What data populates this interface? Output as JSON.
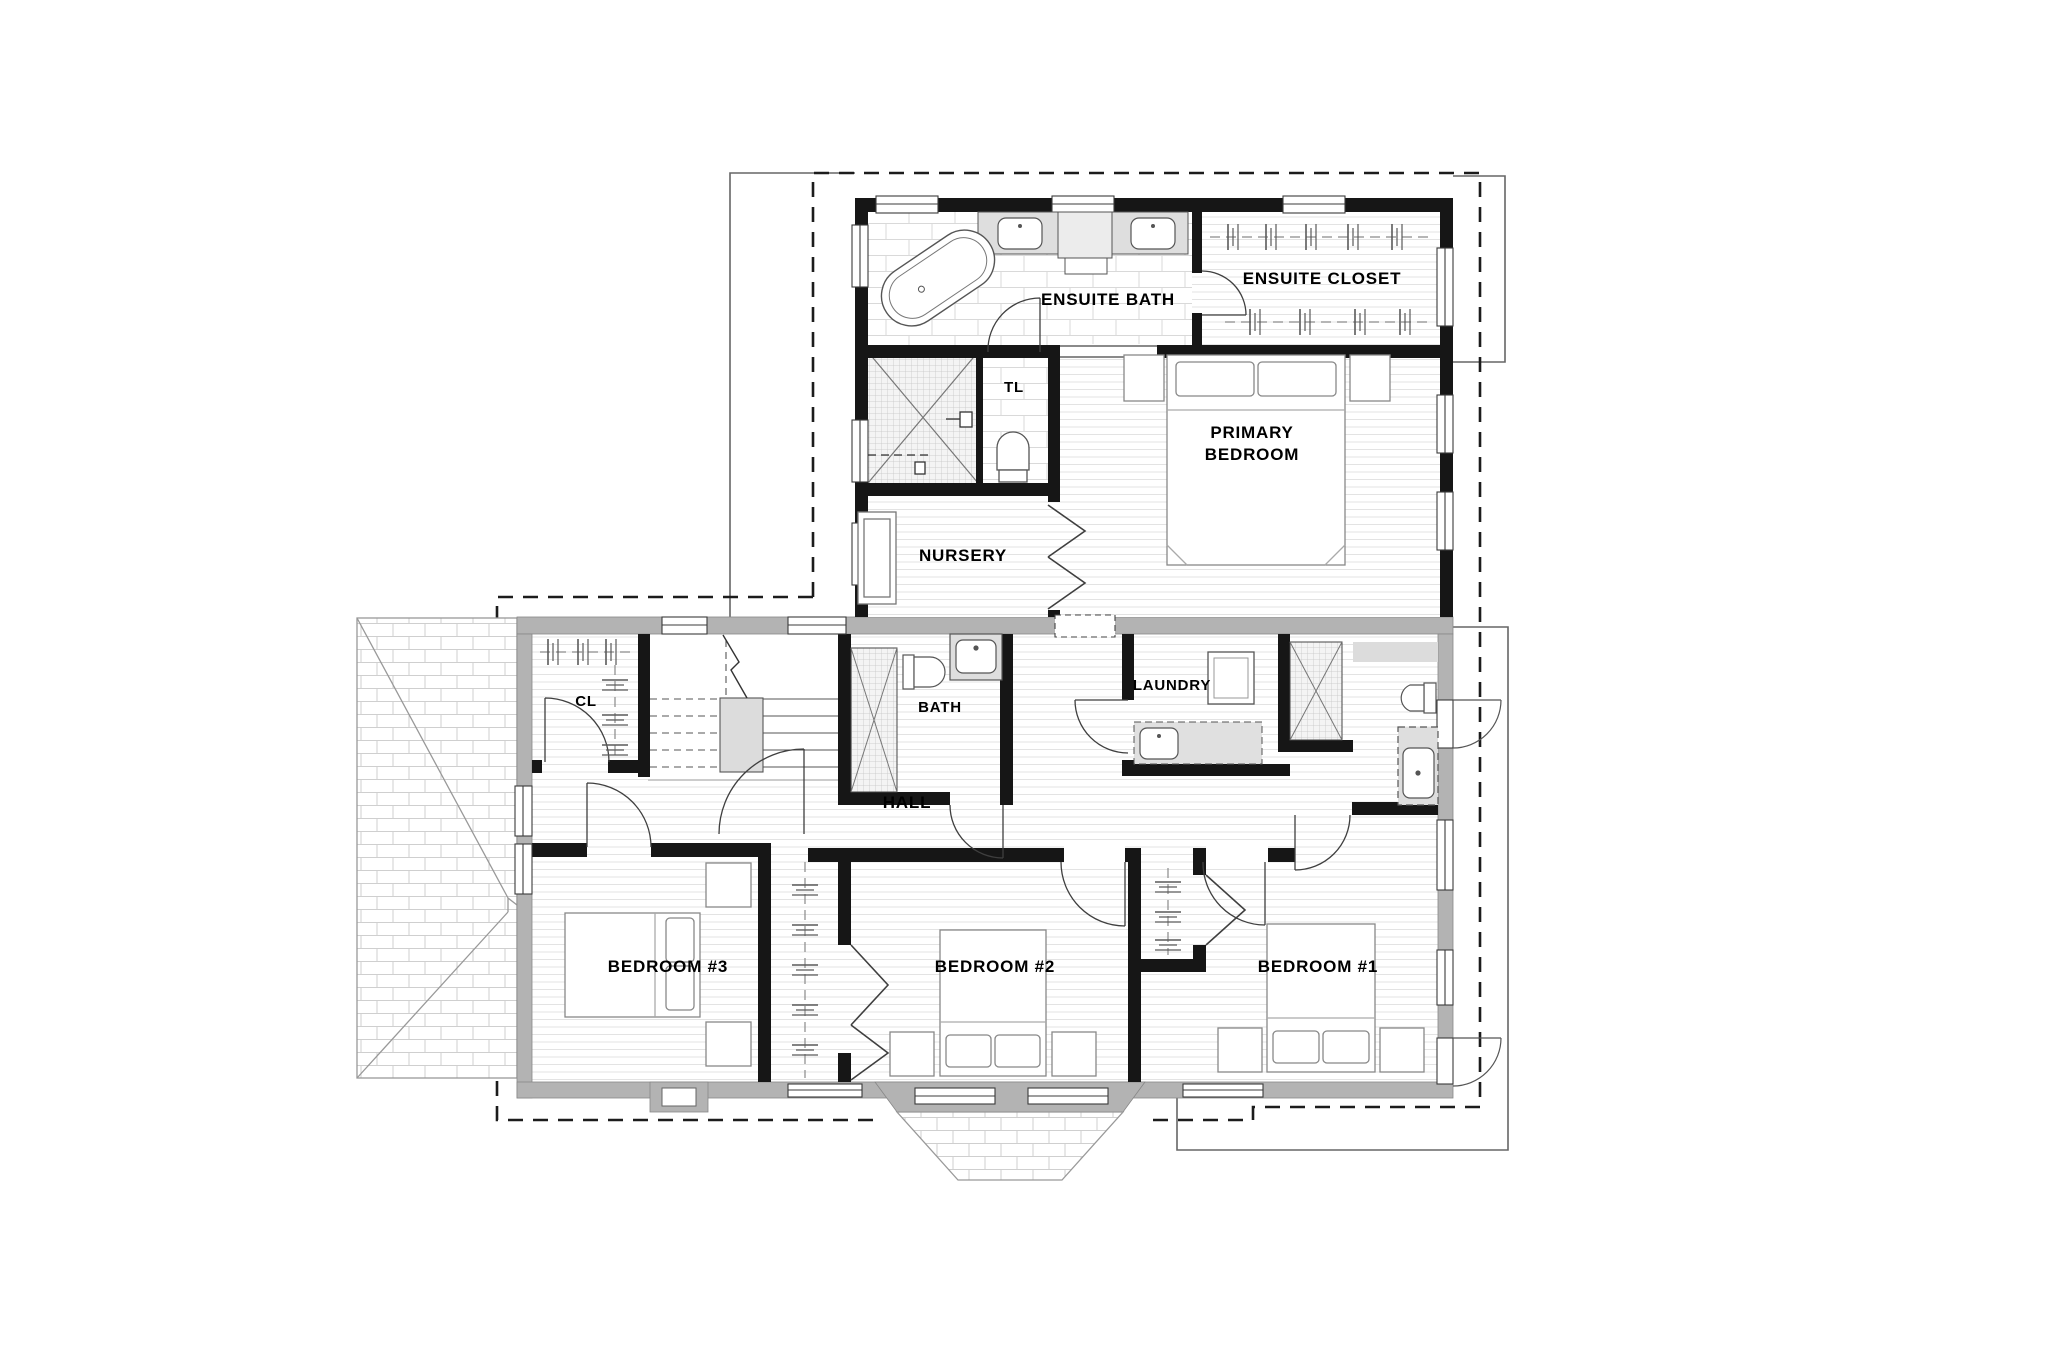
{
  "title": "Second floor plan",
  "rooms": {
    "ensuite_bath": "ENSUITE BATH",
    "ensuite_closet": "ENSUITE CLOSET",
    "toilet_room": "TL",
    "primary_bedroom_line1": "PRIMARY",
    "primary_bedroom_line2": "BEDROOM",
    "nursery": "NURSERY",
    "hall_closet": "CL",
    "bath": "BATH",
    "laundry": "LAUNDRY",
    "hall": "HALL",
    "bedroom3": "BEDROOM #3",
    "bedroom2": "BEDROOM #2",
    "bedroom1": "BEDROOM #1"
  },
  "colors": {
    "new_wall": "#161616",
    "existing_wall": "#b3b3b3",
    "floor_line": "#e3e3e3",
    "annotation_dash": "#1c1c1c"
  }
}
